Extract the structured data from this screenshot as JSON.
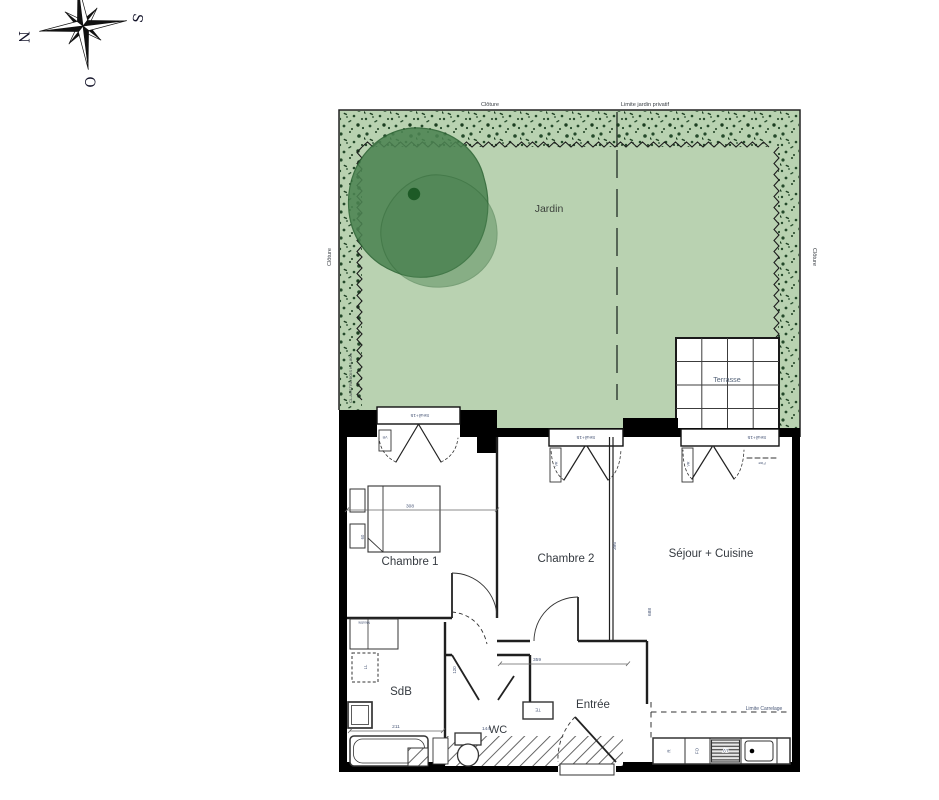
{
  "compass": {
    "n": "N",
    "s": "S",
    "o": "O"
  },
  "garden": {
    "jardin": "Jardin",
    "cloture_top": "Clôture",
    "cloture_left": "Clôture",
    "cloture_right": "Clôture",
    "limite_jardin": "Limite jardin privatif",
    "claustra": "CL.AUSTRA BOIS h=1.80m",
    "terrasse": "Terrasse"
  },
  "rooms": {
    "chambre1": "Chambre 1",
    "chambre2": "Chambre 2",
    "sejour": "Séjour + Cuisine",
    "sdb": "SdB",
    "wc": "WC",
    "entree": "Entrée"
  },
  "windows": {
    "seuil": "Seuil+15",
    "vr": "VR",
    "fixe": "Fixe"
  },
  "kitchen": {
    "r": "R",
    "fo": "FO",
    "lv": "LV"
  },
  "fixtures": {
    "ll": "LL",
    "te": "TE",
    "meuble": "Meuble"
  },
  "dims": {
    "d308": "308",
    "d396": "396",
    "d688": "688",
    "d359": "359",
    "d211": "211",
    "d144": "144",
    "d120": "120",
    "d60": "60"
  },
  "notes": {
    "limite_carrelage": "Limite Carrelage"
  },
  "colors": {
    "garden_green": "#b9d2b1",
    "hedge_dark": "#24492a",
    "tree_green": "#4c8452",
    "tree_outline": "#2d6434",
    "tree_dot": "#1d5a26",
    "wall_black": "#000000",
    "annotation_blue": "#4a5878",
    "label_gray": "#3a3f45"
  }
}
